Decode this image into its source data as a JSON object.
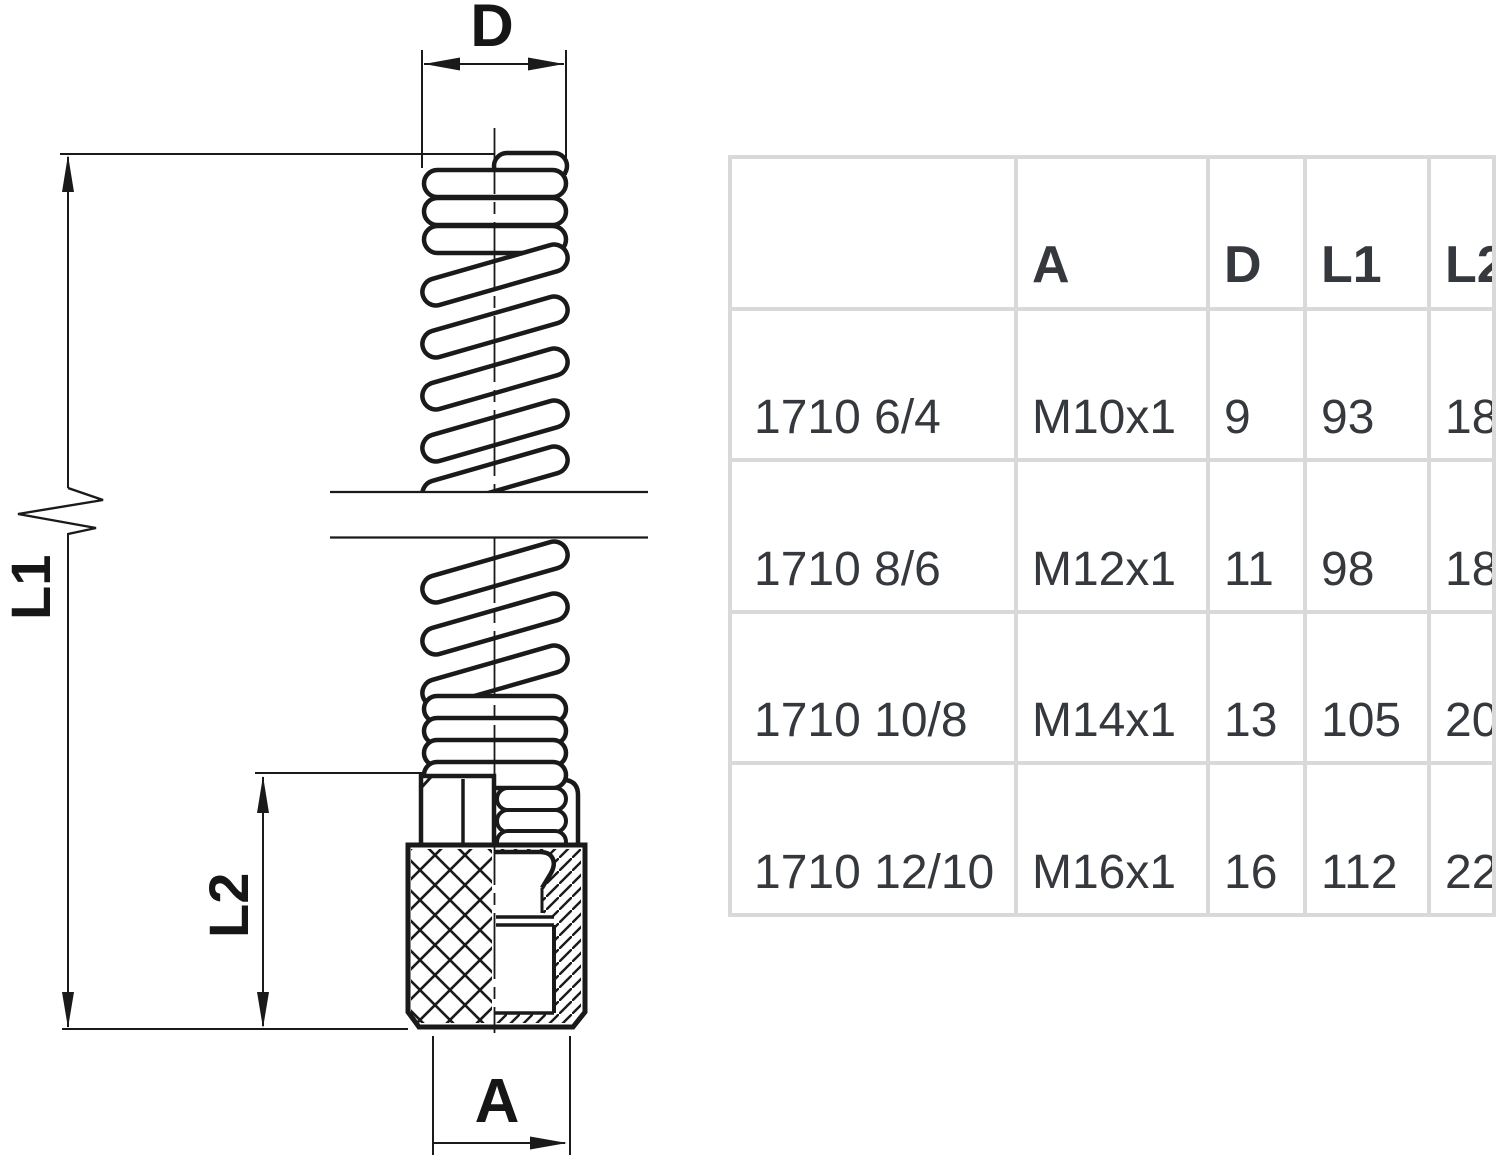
{
  "drawing": {
    "labels": {
      "d": "D",
      "l1": "L1",
      "l2": "L2",
      "a": "A"
    },
    "line_color": "#1a1a1a"
  },
  "table": {
    "border_color": "#d9d9d9",
    "text_color": "#35393d",
    "header": [
      "",
      "A",
      "D",
      "L1",
      "L2"
    ],
    "rows": [
      [
        "1710 6/4",
        "M10x1",
        "9",
        "93",
        "18"
      ],
      [
        "1710 8/6",
        "M12x1",
        "11",
        "98",
        "18"
      ],
      [
        "1710 10/8",
        "M14x1",
        "13",
        "105",
        "20"
      ],
      [
        "1710 12/10",
        "M16x1",
        "16",
        "112",
        "22"
      ]
    ]
  }
}
